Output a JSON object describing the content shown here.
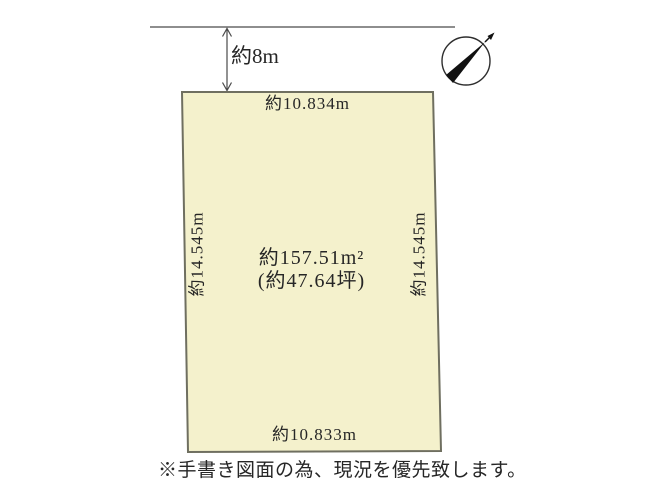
{
  "diagram": {
    "setback": {
      "label": "約8m"
    },
    "plot": {
      "top_dimension": "約10.834m",
      "bottom_dimension": "約10.833m",
      "left_dimension": "約14.545m",
      "right_dimension": "約14.545m",
      "area_sqm": "約157.51m²",
      "area_tsubo": "(約47.64坪)"
    },
    "note": "※手書き図面の為、現況を優先致します。",
    "icons": {
      "compass": "north-compass"
    },
    "colors": {
      "plot_fill": "#f4f1cc",
      "plot_border": "#6f6f60",
      "line": "#4a4a4a",
      "text": "#262626",
      "needle": "#111111"
    }
  }
}
